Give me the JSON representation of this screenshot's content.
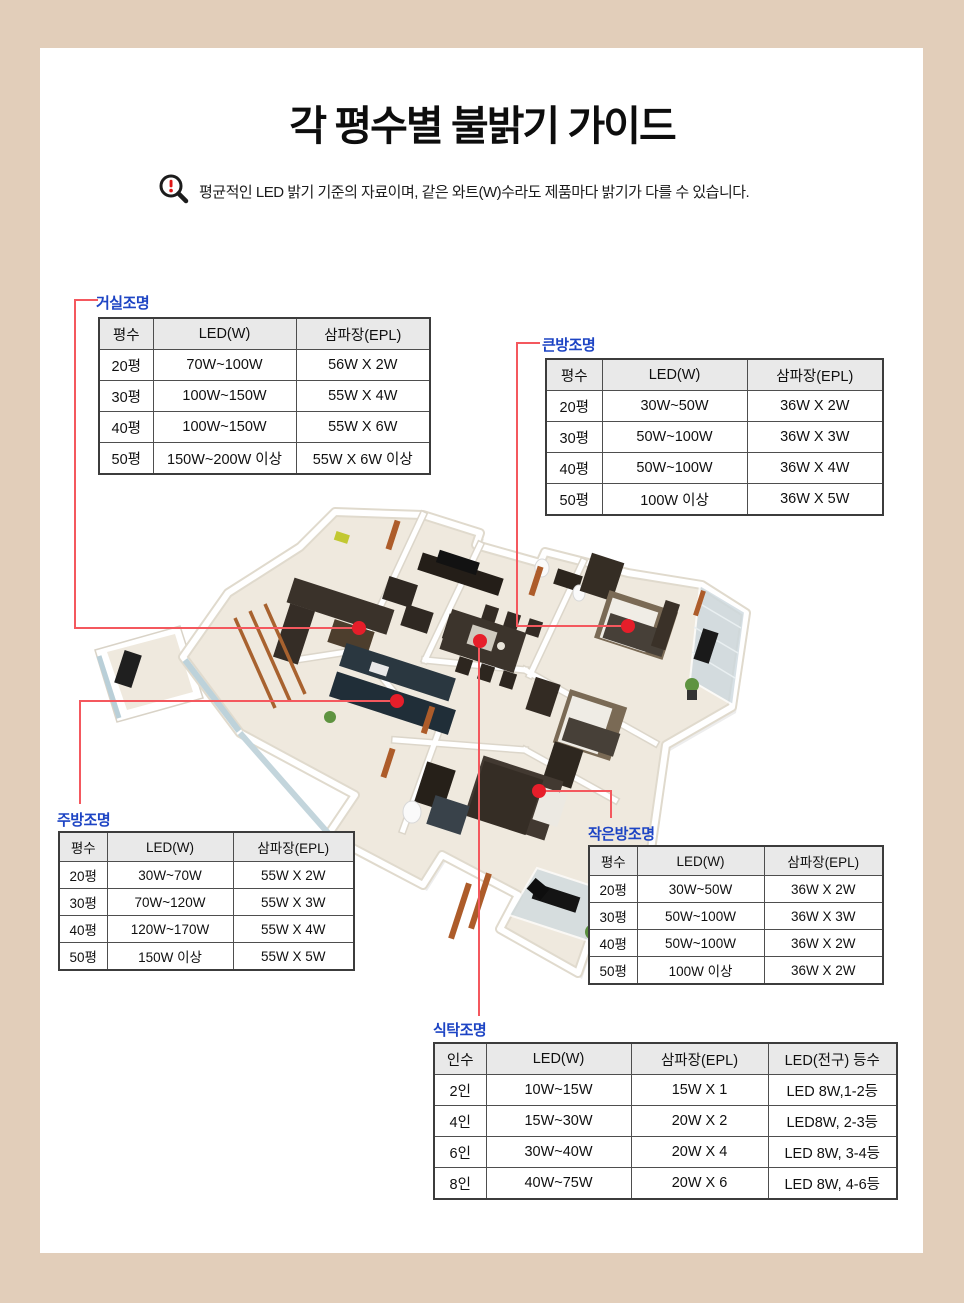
{
  "page": {
    "title": "각 평수별 불밝기 가이드",
    "notice": "평균적인 LED 밝기 기준의 자료이며, 같은 와트(W)수라도 제품마다 밝기가 다를 수 있습니다.",
    "colors": {
      "frame_beige": "#e2ceba",
      "label_blue": "#1d44c4",
      "line_red": "#f4585e",
      "dot_red": "#e61e2a",
      "table_header_gray": "#e9e9e9"
    },
    "icons": [
      {
        "name": "magnifier-alert-icon",
        "meaning": "notice / caution magnifier with red exclamation mark"
      }
    ]
  },
  "tables": {
    "living": {
      "label": "거실조명",
      "headers": [
        "평수",
        "LED(W)",
        "삼파장(EPL)"
      ],
      "rows": [
        [
          "20평",
          "70W~100W",
          "56W X 2W"
        ],
        [
          "30평",
          "100W~150W",
          "55W X 4W"
        ],
        [
          "40평",
          "100W~150W",
          "55W X 6W"
        ],
        [
          "50평",
          "150W~200W 이상",
          "55W X 6W 이상"
        ]
      ]
    },
    "big_room": {
      "label": "큰방조명",
      "headers": [
        "평수",
        "LED(W)",
        "삼파장(EPL)"
      ],
      "rows": [
        [
          "20평",
          "30W~50W",
          "36W X 2W"
        ],
        [
          "30평",
          "50W~100W",
          "36W X 3W"
        ],
        [
          "40평",
          "50W~100W",
          "36W X 4W"
        ],
        [
          "50평",
          "100W 이상",
          "36W X 5W"
        ]
      ]
    },
    "kitchen": {
      "label": "주방조명",
      "headers": [
        "평수",
        "LED(W)",
        "삼파장(EPL)"
      ],
      "rows": [
        [
          "20평",
          "30W~70W",
          "55W X 2W"
        ],
        [
          "30평",
          "70W~120W",
          "55W X 3W"
        ],
        [
          "40평",
          "120W~170W",
          "55W X 4W"
        ],
        [
          "50평",
          "150W 이상",
          "55W X 5W"
        ]
      ]
    },
    "small_room": {
      "label": "작은방조명",
      "headers": [
        "평수",
        "LED(W)",
        "삼파장(EPL)"
      ],
      "rows": [
        [
          "20평",
          "30W~50W",
          "36W X 2W"
        ],
        [
          "30평",
          "50W~100W",
          "36W X 3W"
        ],
        [
          "40평",
          "50W~100W",
          "36W X 2W"
        ],
        [
          "50평",
          "100W 이상",
          "36W X 2W"
        ]
      ]
    },
    "dining": {
      "label": "식탁조명",
      "headers": [
        "인수",
        "LED(W)",
        "삼파장(EPL)",
        "LED(전구) 등수"
      ],
      "rows": [
        [
          "2인",
          "10W~15W",
          "15W X 1",
          "LED 8W,1-2등"
        ],
        [
          "4인",
          "15W~30W",
          "20W X 2",
          "LED8W, 2-3등"
        ],
        [
          "6인",
          "30W~40W",
          "20W X 4",
          "LED 8W, 3-4등"
        ],
        [
          "8인",
          "40W~75W",
          "20W X 6",
          "LED 8W, 4-6등"
        ]
      ]
    }
  }
}
